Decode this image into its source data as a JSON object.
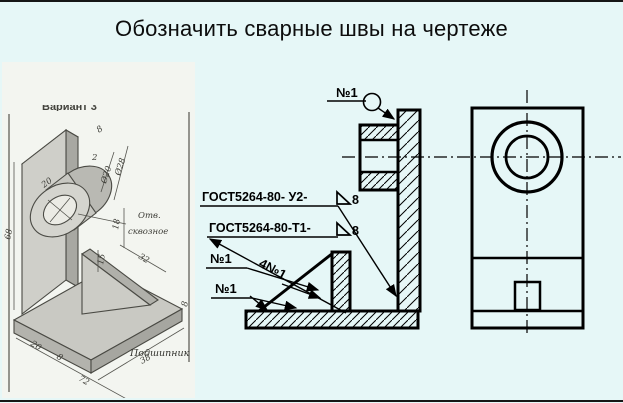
{
  "title": "Обозначить сварные швы на чертеже",
  "colors": {
    "background": "#e6f7f7",
    "ink": "#000000",
    "pencil_stroke": "#4a4a44",
    "inset_background": "#f3f5f0"
  },
  "inset": {
    "variant_label": "Вариант 3",
    "caption": "Подшипник",
    "hole_note_line1": "Отв.",
    "hole_note_line2": "сквозное",
    "dimensions": {
      "plate_height": "68",
      "boss_length": "20",
      "bore_diameter": "Ø20",
      "boss_diameter": "Ø28",
      "top_offset": "8",
      "top_gap": "2",
      "boss_drop": "18",
      "shelf_depth": "32",
      "rib_height": "15",
      "base_left": "20",
      "plate_thickness": "8",
      "base_length": "72",
      "base_width": "38",
      "base_thickness": "8"
    }
  },
  "section_view": {
    "weld_flag": "№1",
    "gost_callout_1": {
      "text": "ГОСТ5264-80- У2-",
      "size": "8"
    },
    "gost_callout_2": {
      "text": "ГОСТ5264-80-Т1-",
      "size": "8"
    },
    "rib_weld_count": "4№1",
    "weld_label_a": "№1",
    "weld_label_b": "№1"
  }
}
